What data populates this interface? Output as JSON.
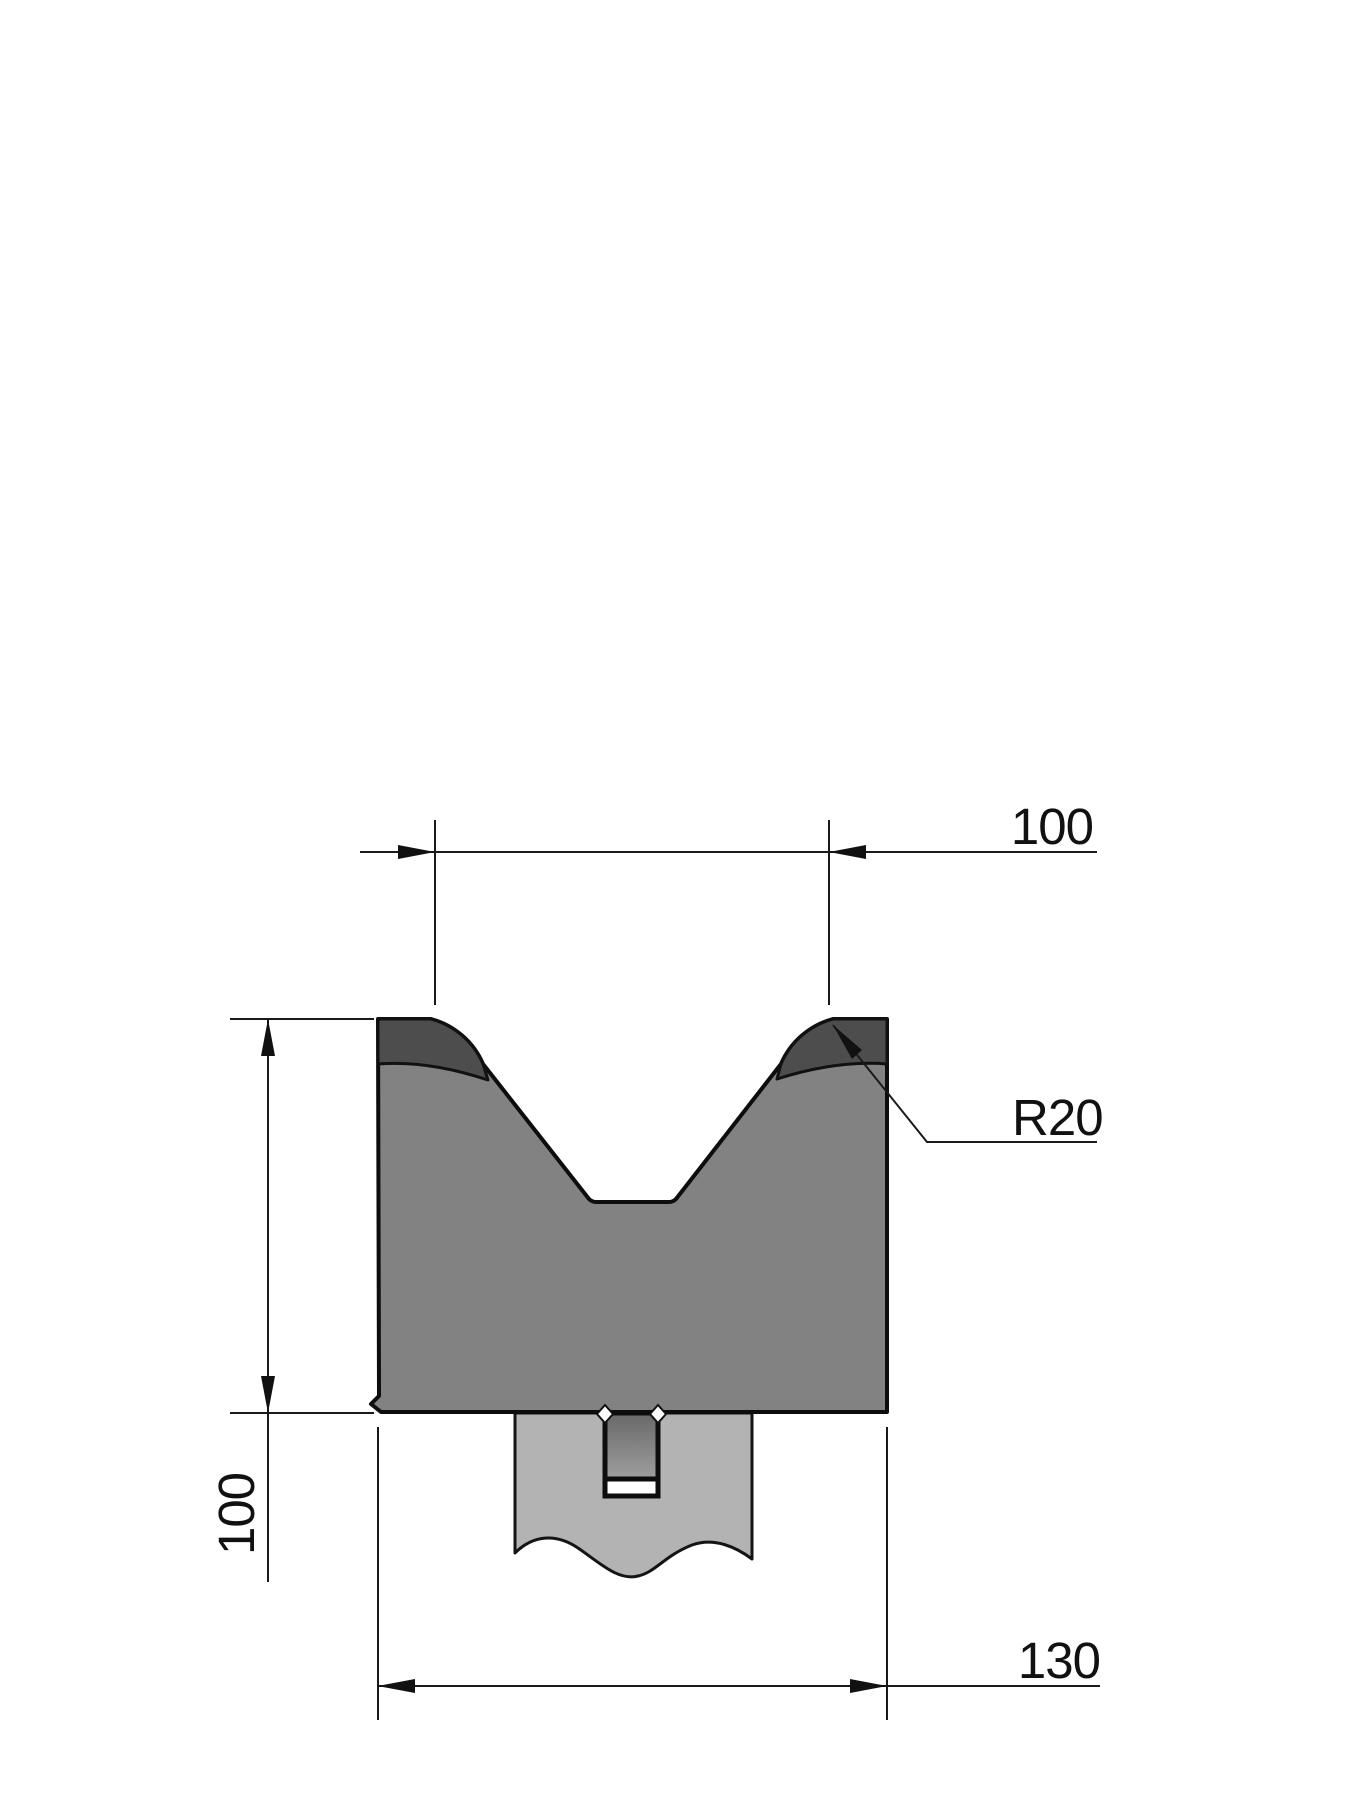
{
  "drawing": {
    "labels": {
      "v_opening_width": "100",
      "die_height": "100",
      "base_width": "130",
      "corner_radius": "R20"
    },
    "colors": {
      "background": "#ffffff",
      "die_body": "#828282",
      "hardened_zone": "#4d4d4d",
      "holder": "#b3b3b3",
      "tang_gradient_top": "#686868",
      "tang_gradient_bottom": "#9e9e9e",
      "outline": "#0d0d0d",
      "dimension_line": "#1a1a1a",
      "text": "#111111"
    }
  }
}
